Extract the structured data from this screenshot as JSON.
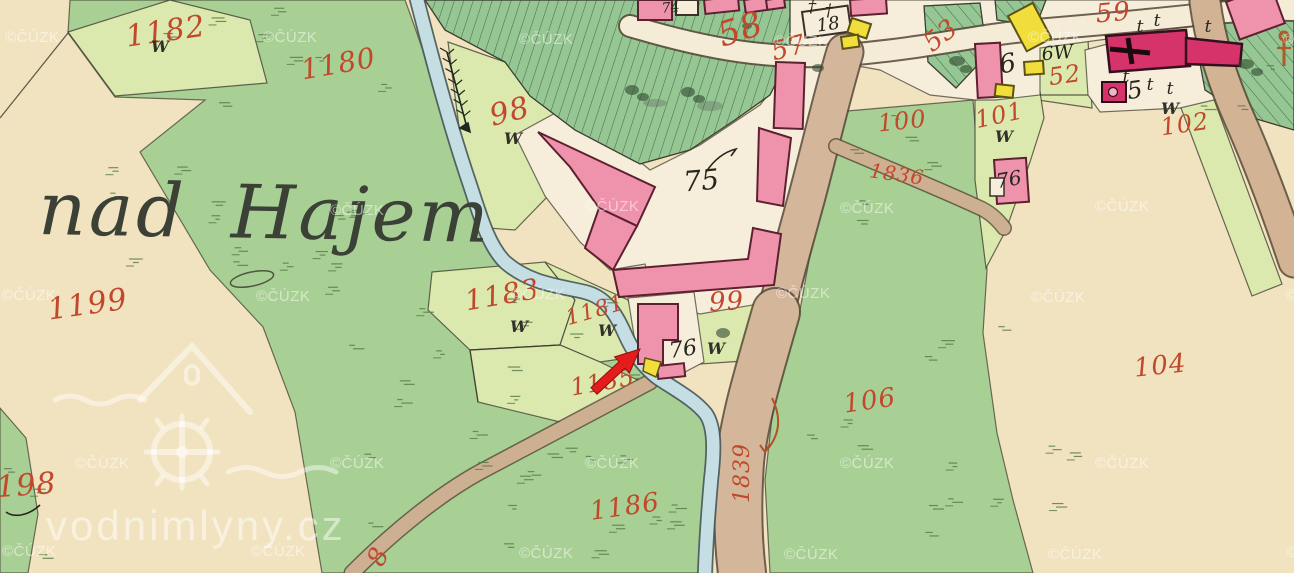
{
  "map": {
    "region_name": "nad Hajem",
    "copyright_watermark": "©ČÚZK",
    "site_watermark": "vodnimlyny.cz",
    "meadow_letter": "W",
    "annotation": {
      "type": "red-arrow",
      "color": "#e51c1c",
      "points_at": "mill building 76"
    },
    "colors": {
      "paper": "#f2e3c0",
      "meadow": "#a9d094",
      "pale_parcel": "#dce9ae",
      "forest": "#96c693",
      "stream": "#c4dee3",
      "road": "#d2b394",
      "village_ground": "#f6eeda",
      "building_pink": "#ef93ac",
      "building_red": "#d6336a",
      "building_yellow": "#f2de3b",
      "number_red": "#c1482c",
      "annotation_red": "#e51c1c"
    },
    "red_numbers": [
      {
        "t": "1182",
        "x": 167,
        "y": 41,
        "r": -8,
        "s": 30
      },
      {
        "t": "1180",
        "x": 340,
        "y": 73,
        "r": -10,
        "s": 28
      },
      {
        "t": "98",
        "x": 512,
        "y": 121,
        "r": -14,
        "s": 30
      },
      {
        "t": "58",
        "x": 744,
        "y": 40,
        "r": -18,
        "s": 34
      },
      {
        "t": "57",
        "x": 791,
        "y": 56,
        "r": -15,
        "s": 26
      },
      {
        "t": "53",
        "x": 946,
        "y": 42,
        "r": -38,
        "s": 26
      },
      {
        "t": "59",
        "x": 1114,
        "y": 21,
        "r": -5,
        "s": 26
      },
      {
        "t": "52",
        "x": 1066,
        "y": 83,
        "r": -8,
        "s": 24
      },
      {
        "t": "100",
        "x": 903,
        "y": 129,
        "r": -6,
        "s": 24
      },
      {
        "t": "101",
        "x": 1001,
        "y": 123,
        "r": -12,
        "s": 24
      },
      {
        "t": "102",
        "x": 1186,
        "y": 132,
        "r": -8,
        "s": 24
      },
      {
        "t": "1836",
        "x": 896,
        "y": 181,
        "r": 8,
        "s": 20
      },
      {
        "t": "1199",
        "x": 89,
        "y": 314,
        "r": -8,
        "s": 30
      },
      {
        "t": "1183",
        "x": 504,
        "y": 304,
        "r": -10,
        "s": 28
      },
      {
        "t": "1181",
        "x": 597,
        "y": 317,
        "r": -16,
        "s": 22
      },
      {
        "t": "99",
        "x": 727,
        "y": 310,
        "r": -3,
        "s": 26
      },
      {
        "t": "1185",
        "x": 604,
        "y": 390,
        "r": -10,
        "s": 24
      },
      {
        "t": "106",
        "x": 871,
        "y": 409,
        "r": -8,
        "s": 26
      },
      {
        "t": "104",
        "x": 1161,
        "y": 374,
        "r": -6,
        "s": 26
      },
      {
        "t": "1186",
        "x": 626,
        "y": 515,
        "r": -8,
        "s": 26
      },
      {
        "t": "1839",
        "x": 749,
        "y": 473,
        "r": -90,
        "s": 22
      },
      {
        "t": "198",
        "x": 27,
        "y": 495,
        "r": -4,
        "s": 30
      },
      {
        "t": "8",
        "x": 386,
        "y": 560,
        "r": -65,
        "s": 26
      }
    ],
    "black_numbers": [
      {
        "t": "75",
        "x": 702,
        "y": 190,
        "r": -5,
        "s": 28
      },
      {
        "t": "76",
        "x": 684,
        "y": 356,
        "r": -8,
        "s": 22
      },
      {
        "t": "76",
        "x": 1010,
        "y": 186,
        "r": -10,
        "s": 20
      },
      {
        "t": "74",
        "x": 671,
        "y": 12,
        "r": -5,
        "s": 14
      },
      {
        "t": "18",
        "x": 829,
        "y": 30,
        "r": -8,
        "s": 18
      },
      {
        "t": "5",
        "x": 1136,
        "y": 98,
        "r": -8,
        "s": 24
      },
      {
        "t": "6",
        "x": 1009,
        "y": 72,
        "r": -10,
        "s": 26
      },
      {
        "t": "6W",
        "x": 1058,
        "y": 59,
        "r": -5,
        "s": 19
      }
    ],
    "meadow_marks": [
      {
        "x": 160,
        "y": 52
      },
      {
        "x": 513,
        "y": 144
      },
      {
        "x": 519,
        "y": 332
      },
      {
        "x": 607,
        "y": 336
      },
      {
        "x": 716,
        "y": 354
      },
      {
        "x": 1004,
        "y": 142
      },
      {
        "x": 1170,
        "y": 114
      }
    ],
    "tree_marks": [
      {
        "g": "t",
        "x": 1140,
        "y": 32
      },
      {
        "g": "t",
        "x": 1157,
        "y": 26
      },
      {
        "g": "t",
        "x": 1208,
        "y": 32
      },
      {
        "g": "t",
        "x": 1126,
        "y": 82
      },
      {
        "g": "t",
        "x": 1150,
        "y": 90
      },
      {
        "g": "t",
        "x": 1170,
        "y": 94
      },
      {
        "g": "†",
        "x": 812,
        "y": 12
      },
      {
        "g": "†",
        "x": 829,
        "y": 16
      }
    ],
    "copyright_positions": [
      [
        5,
        42
      ],
      [
        263,
        42
      ],
      [
        519,
        44
      ],
      [
        774,
        46
      ],
      [
        1028,
        42
      ],
      [
        1283,
        44
      ],
      [
        330,
        215
      ],
      [
        585,
        211
      ],
      [
        840,
        213
      ],
      [
        1095,
        211
      ],
      [
        2,
        300
      ],
      [
        256,
        301
      ],
      [
        511,
        299
      ],
      [
        776,
        298
      ],
      [
        1031,
        302
      ],
      [
        1286,
        300
      ],
      [
        75,
        468
      ],
      [
        330,
        468
      ],
      [
        585,
        468
      ],
      [
        840,
        468
      ],
      [
        1095,
        468
      ],
      [
        2,
        556
      ],
      [
        251,
        556
      ],
      [
        519,
        558
      ],
      [
        784,
        559
      ],
      [
        1048,
        559
      ],
      [
        1286,
        557
      ]
    ],
    "symbols": {
      "stream_flow_arrow": {
        "x": 447,
        "y": 52
      },
      "wayside_cross": {
        "x": 1284,
        "y": 52
      }
    }
  }
}
